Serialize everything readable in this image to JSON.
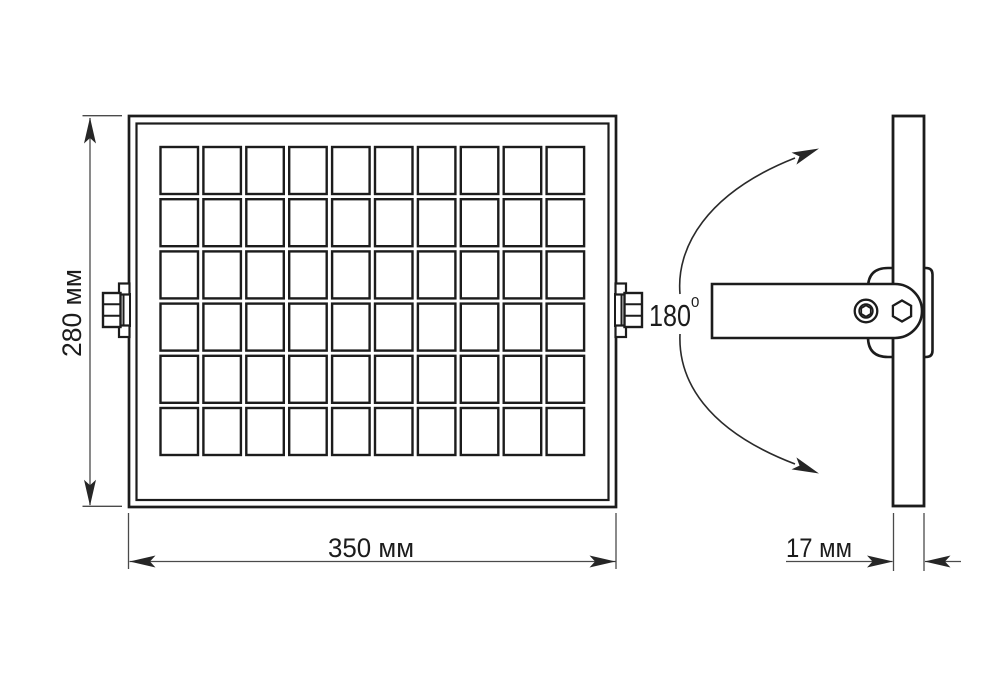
{
  "drawing": {
    "kind": "floodlight dimensional drawing",
    "labels": {
      "height": "280 мм",
      "width": "350 мм",
      "thickness": "17 мм",
      "rotation": "180",
      "rotation_sup": "0"
    },
    "front_view": {
      "grid": {
        "cols": 10,
        "rows": 6
      }
    },
    "colors": {
      "outline": "#1c1c1c",
      "dim_line": "#4a4a4a",
      "background": "#ffffff"
    }
  }
}
